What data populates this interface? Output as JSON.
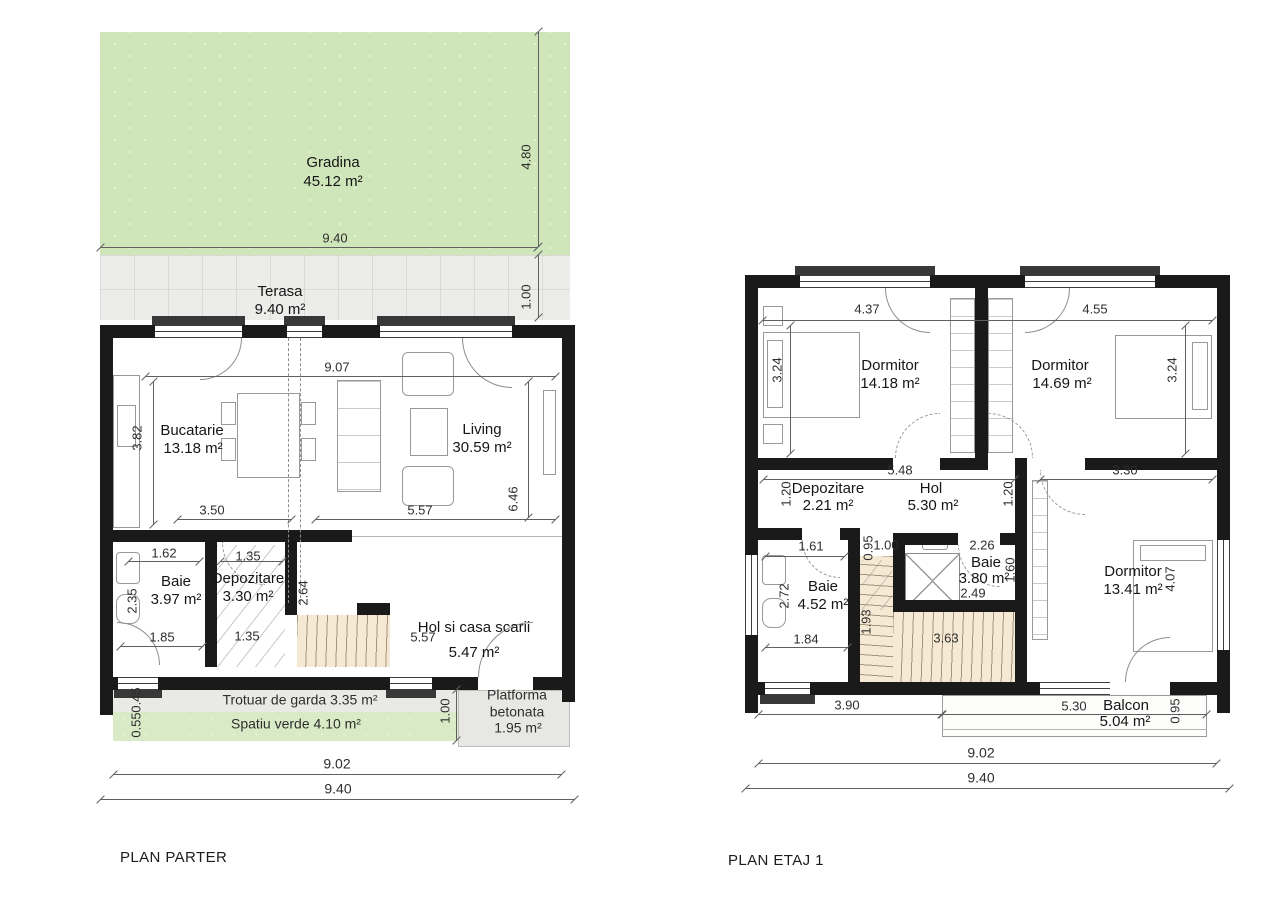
{
  "parter": {
    "title": "PLAN PARTER",
    "rooms": {
      "gradina": {
        "name": "Gradina",
        "area": "45.12 m²"
      },
      "terasa": {
        "name": "Terasa",
        "area": "9.40 m²"
      },
      "bucatarie": {
        "name": "Bucatarie",
        "area": "13.18 m²"
      },
      "living": {
        "name": "Living",
        "area": "30.59 m²"
      },
      "baie": {
        "name": "Baie",
        "area": "3.97 m²"
      },
      "depozitare": {
        "name": "Depozitare",
        "area": "3.30 m²"
      },
      "hol": {
        "name": "Hol si casa scarii",
        "area": "5.47 m²"
      },
      "trotuar": {
        "label": "Trotuar de garda 3.35 m²"
      },
      "spatiu_verde": {
        "label": "Spatiu verde 4.10 m²"
      },
      "platforma": {
        "name": "Platforma betonata",
        "area": "1.95 m²"
      }
    },
    "dims": {
      "gradina_w": "9.40",
      "gradina_h": "4.80",
      "terasa_h": "1.00",
      "interior_w": "9.07",
      "bucatarie_h": "3.82",
      "bucatarie_w": "3.50",
      "living_w": "5.57",
      "living_h": "6.46",
      "baie_top": "1.62",
      "baie_left": "2.35",
      "baie_bottom": "1.85",
      "dep_top": "1.35",
      "dep_bottom": "1.35",
      "scara_len": "2.64",
      "hol_w": "5.57",
      "trotuar_h": "0.45",
      "verde_h": "0.55",
      "platforma_h": "1.00",
      "total_int": "9.02",
      "total": "9.40"
    }
  },
  "etaj": {
    "title": "PLAN ETAJ 1",
    "rooms": {
      "dormitor1": {
        "name": "Dormitor",
        "area": "14.18 m²"
      },
      "dormitor2": {
        "name": "Dormitor",
        "area": "14.69 m²"
      },
      "dormitor3": {
        "name": "Dormitor",
        "area": "13.41 m²"
      },
      "depozitare": {
        "name": "Depozitare",
        "area": "2.21 m²"
      },
      "hol": {
        "name": "Hol",
        "area": "5.30 m²"
      },
      "baie1": {
        "name": "Baie",
        "area": "4.52 m²"
      },
      "baie2": {
        "name": "Baie",
        "area": "3.80 m²"
      },
      "balcon": {
        "name": "Balcon",
        "area": "5.04 m²"
      }
    },
    "dims": {
      "dorm1_w": "4.37",
      "dorm2_w": "4.55",
      "dorm1_h": "3.24",
      "dorm2_h": "3.24",
      "hol_w": "5.48",
      "dorm3_top": "3.30",
      "dep_h": "1.20",
      "hol_h": "1.20",
      "baie1_top": "1.61",
      "palier_w1": "0.95",
      "palier_w2": "1.00",
      "baie2_top": "2.26",
      "baie2_h": "1.60",
      "baie1_left": "2.72",
      "baie2_bottom": "2.49",
      "scara_v": "1.93",
      "scara_w": "3.63",
      "baie1_bottom": "1.84",
      "dorm3_h": "4.07",
      "stanga_w": "3.90",
      "balcon_w": "5.30",
      "balcon_h": "0.95",
      "total_int": "9.02",
      "total": "9.40"
    }
  }
}
